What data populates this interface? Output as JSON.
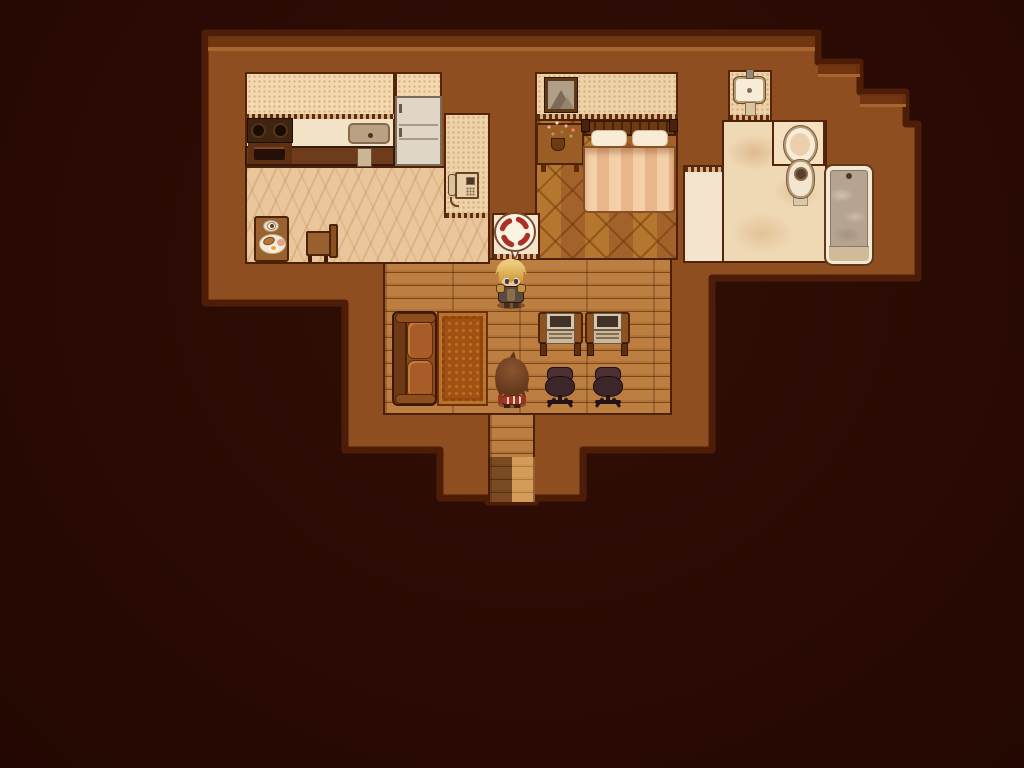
{
  "scene": {
    "title": "Top-down RPG house interior (sepia)",
    "view": "overhead tile map",
    "exit": {
      "label": "South exit corridor"
    }
  },
  "palette": {
    "background": "#2a0a04",
    "wall_fill": "#8f4e20",
    "wall_outline": "#4e1d07",
    "wall_top_shade": "#6d3310",
    "wall_highlight": "#a8662e",
    "kitchen_floor": "#eac69c",
    "wood_floor": "#b07439",
    "parquet": "#b5772f",
    "marble": "#efd9b5",
    "ivory_tile": "#f3e5cd",
    "anger_red": "#ad3122",
    "balloon_white": "#fbf4e3"
  },
  "rooms": {
    "kitchen": {
      "label": "Kitchen"
    },
    "bedroom": {
      "label": "Bedroom"
    },
    "bathroom": {
      "label": "Bathroom"
    },
    "living_room": {
      "label": "Living room"
    },
    "corridor": {
      "label": "South corridor exit"
    }
  },
  "objects": {
    "stove": {
      "label": "Stove with two burners and oven"
    },
    "counter": {
      "label": "Kitchen counter"
    },
    "kitchen_sink": {
      "label": "Kitchen sink"
    },
    "fridge": {
      "label": "Refrigerator"
    },
    "breakfast_table": {
      "label": "Table with coffee and breakfast plate"
    },
    "kitchen_chair": {
      "label": "Wooden chair"
    },
    "intercom_phone": {
      "label": "Wall intercom phone"
    },
    "picture_frame": {
      "label": "Framed mountain picture"
    },
    "nightstand": {
      "label": "Nightstand with flower vase"
    },
    "bed": {
      "label": "Double bed"
    },
    "bathroom_sink": {
      "label": "Wall-mounted sink"
    },
    "toilet": {
      "label": "Toilet"
    },
    "bathtub": {
      "label": "Bathtub filled with water"
    },
    "couch": {
      "label": "Leather couch"
    },
    "rug": {
      "label": "Ornate rug"
    },
    "desk_left": {
      "label": "Desk with laptop (left)"
    },
    "desk_right": {
      "label": "Desk with laptop (right)"
    },
    "laptop_left": {
      "label": "Laptop (left)"
    },
    "laptop_right": {
      "label": "Laptop (right)"
    },
    "office_chair_left": {
      "label": "Office chair (left)"
    },
    "office_chair_right": {
      "label": "Office chair (right)"
    }
  },
  "characters": {
    "hero": {
      "label": "Blond armored character facing south",
      "emote": "anger"
    },
    "kid": {
      "label": "Brown-haired character facing north"
    }
  },
  "emote": {
    "type": "anger",
    "description": "Red popping-vein anger mark in white speech balloon"
  }
}
